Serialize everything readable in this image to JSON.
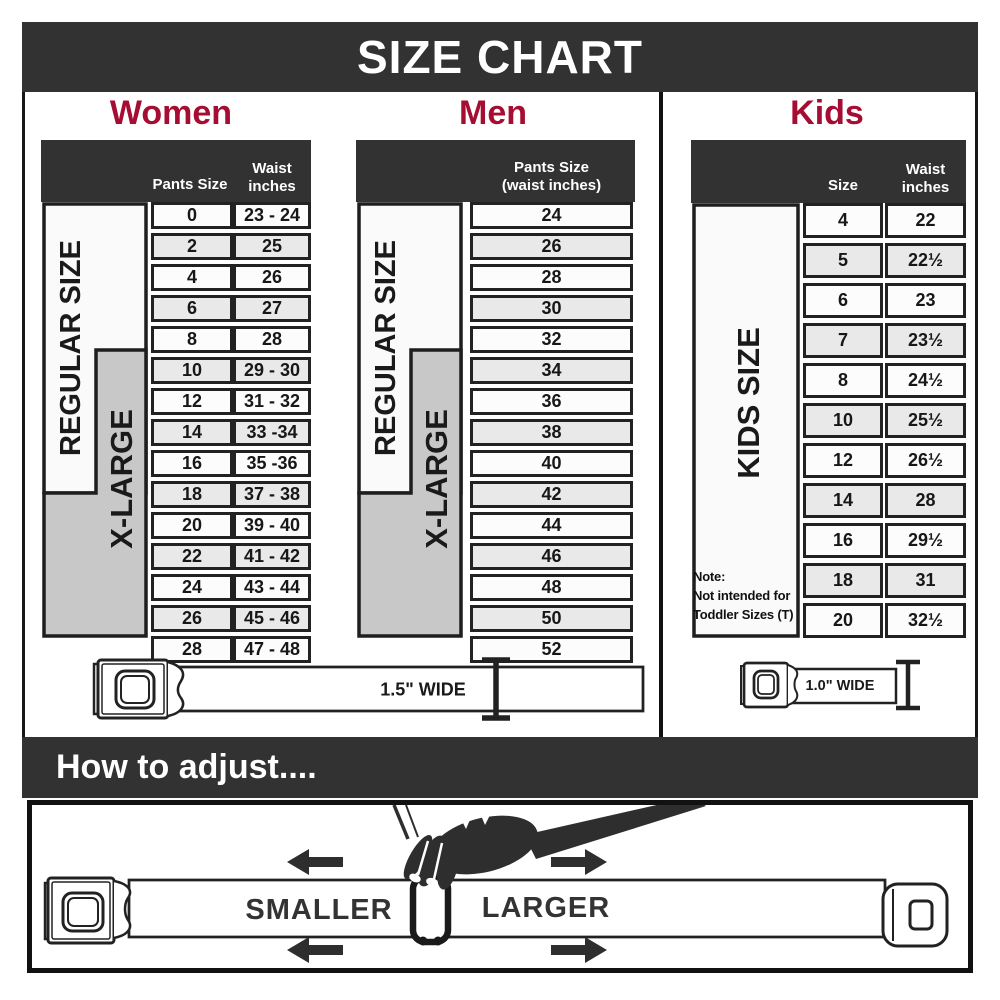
{
  "banner": {
    "title": "SIZE CHART"
  },
  "women": {
    "heading": "Women",
    "header": {
      "col1": "Pants Size",
      "col2_line1": "Waist",
      "col2_line2": "inches"
    },
    "labels": {
      "regular": "REGULAR SIZE",
      "xlarge": "X-LARGE"
    },
    "rows": [
      {
        "size": "0",
        "waist": "23 - 24"
      },
      {
        "size": "2",
        "waist": "25"
      },
      {
        "size": "4",
        "waist": "26"
      },
      {
        "size": "6",
        "waist": "27"
      },
      {
        "size": "8",
        "waist": "28"
      },
      {
        "size": "10",
        "waist": "29 - 30"
      },
      {
        "size": "12",
        "waist": "31 - 32"
      },
      {
        "size": "14",
        "waist": "33 -34"
      },
      {
        "size": "16",
        "waist": "35 -36"
      },
      {
        "size": "18",
        "waist": "37 - 38"
      },
      {
        "size": "20",
        "waist": "39 - 40"
      },
      {
        "size": "22",
        "waist": "41 - 42"
      },
      {
        "size": "24",
        "waist": "43 - 44"
      },
      {
        "size": "26",
        "waist": "45 - 46"
      },
      {
        "size": "28",
        "waist": "47 - 48"
      }
    ],
    "belt_width_label": "1.5\" WIDE"
  },
  "men": {
    "heading": "Men",
    "header": {
      "line1": "Pants Size",
      "line2": "(waist inches)"
    },
    "labels": {
      "regular": "REGULAR SIZE",
      "xlarge": "X-LARGE"
    },
    "rows": [
      "24",
      "26",
      "28",
      "30",
      "32",
      "34",
      "36",
      "38",
      "40",
      "42",
      "44",
      "46",
      "48",
      "50",
      "52"
    ]
  },
  "kids": {
    "heading": "Kids",
    "header": {
      "col1": "Size",
      "col2_line1": "Waist",
      "col2_line2": "inches"
    },
    "label": "KIDS SIZE",
    "note": {
      "line1": "Note:",
      "line2": "Not intended for",
      "line3": "Toddler Sizes (T)"
    },
    "rows": [
      {
        "size": "4",
        "waist": "22"
      },
      {
        "size": "5",
        "waist": "22½"
      },
      {
        "size": "6",
        "waist": "23"
      },
      {
        "size": "7",
        "waist": "23½"
      },
      {
        "size": "8",
        "waist": "24½"
      },
      {
        "size": "10",
        "waist": "25½"
      },
      {
        "size": "12",
        "waist": "26½"
      },
      {
        "size": "14",
        "waist": "28"
      },
      {
        "size": "16",
        "waist": "29½"
      },
      {
        "size": "18",
        "waist": "31"
      },
      {
        "size": "20",
        "waist": "32½"
      }
    ],
    "belt_width_label": "1.0\" WIDE"
  },
  "adjust": {
    "heading": "How to adjust....",
    "smaller": "SMALLER",
    "larger": "LARGER"
  },
  "colors": {
    "accent_red": "#a60d32",
    "dark": "#323232",
    "row_alt": "#e9e9e9",
    "label_gray": "#c8c8c8"
  }
}
